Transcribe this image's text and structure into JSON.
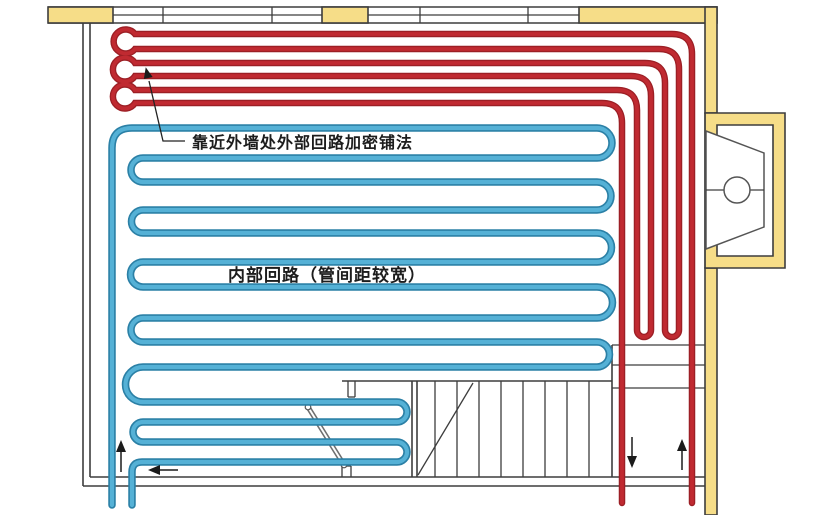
{
  "annotations": {
    "outer_loop_note": "靠近外墙处外部回路加密铺法",
    "inner_loop_note": "内部回路（管间距较宽）"
  },
  "flow_arrows": {
    "blue_supply_direction": "up",
    "blue_return_direction": "left",
    "red_supply_direction": "up",
    "red_return_direction": "down"
  },
  "colors": {
    "pipe-red": "#c02a31",
    "pipe-red-edge": "#9c1f25",
    "pipe-blue": "#55b1d6",
    "pipe-blue-edge": "#2b80a6",
    "wall-yellow": "#f6dd88",
    "wall-line": "#3d3d3d",
    "arrow-ink": "#1b1b1b",
    "bg": "#ffffff"
  }
}
